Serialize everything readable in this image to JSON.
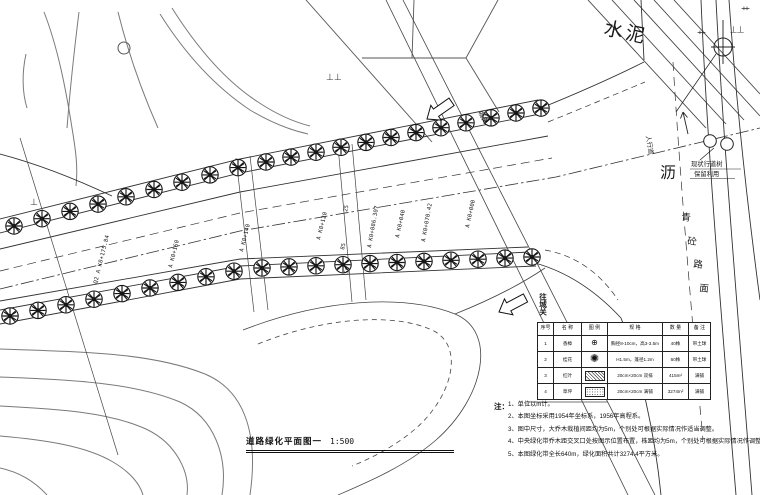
{
  "title": {
    "text": "道路绿化平面图一",
    "scale": "1:500"
  },
  "labels": {
    "cement": "水泥",
    "asphalt_big": "沥",
    "asphalt_chars": [
      "青",
      "砼",
      "路",
      "面"
    ],
    "sidewalk": "人行道",
    "mark_double_t": "⊥⊥",
    "mark_t": "⊥",
    "mark_grass": "艹",
    "mark_double_l": "丄丄",
    "mark_corner": "艹"
  },
  "existing_note": {
    "line1": "现状行道树",
    "line2": "保留利用"
  },
  "directions": {
    "top": "城关",
    "bottom": "往城关"
  },
  "chainages": [
    "Q2 A K0+175.84",
    "A K0+160",
    "A K0+140",
    "A K0+120",
    "A K0+086.307",
    "A K0+040",
    "A K0+070.42",
    "A K0+000"
  ],
  "dims": [
    "25",
    "85",
    "56"
  ],
  "legend_table": {
    "headers": [
      "序号",
      "名 称",
      "图 例",
      "规 格",
      "数 量",
      "备 注"
    ],
    "rows": [
      {
        "no": "1",
        "name": "香樟",
        "spec": "胸径8-10cm，高3-3.5m",
        "qty": "40株",
        "remark": "带土球"
      },
      {
        "no": "2",
        "name": "桂花",
        "spec": "H1.5m，蓬径1.2m",
        "qty": "60株",
        "remark": "带土球"
      },
      {
        "no": "3",
        "name": "红叶",
        "spec": "20cm×20cm 双排",
        "qty": "415m²",
        "remark": "满铺"
      },
      {
        "no": "4",
        "name": "草坪",
        "spec": "20cm×20cm 满铺",
        "qty": "3274m²",
        "remark": "满铺"
      }
    ]
  },
  "notes": {
    "head": "注：",
    "items": [
      "1、单位以m计。",
      "2、本图坐标采用1954年坐标系，1956年高程系。",
      "3、图中尺寸，大乔木栽植间距均为5m，个别处可根据实际情况作适当调整。",
      "4、中央绿化带乔木距交叉口处按图示位置布置，株距均为5m，个别处可根据实际情况作调整。",
      "5、本图绿化带全长640m，绿化面积共计3274.4平方米。"
    ]
  }
}
